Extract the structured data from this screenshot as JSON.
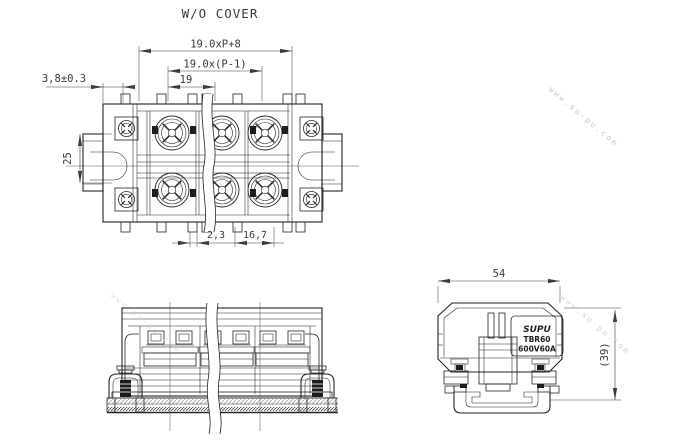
{
  "drawing": {
    "title": "W/O COVER",
    "views": {
      "plan": {
        "dim_total_length": "19.0xP+8",
        "dim_pole_span": "19.0x(P-1)",
        "dim_pitch": "19",
        "dim_end_offset": "3,8±0.3",
        "dim_row_spacing": "25",
        "dim_barrier_width": "2,3",
        "dim_opening_width": "16,7"
      },
      "side": {
        "dim_width": "54",
        "dim_height": "(39)",
        "product_label": {
          "brand": "SUPU",
          "series": "TBR60",
          "rating": "600V60A"
        }
      }
    },
    "watermark": "www.su-pu.com"
  }
}
